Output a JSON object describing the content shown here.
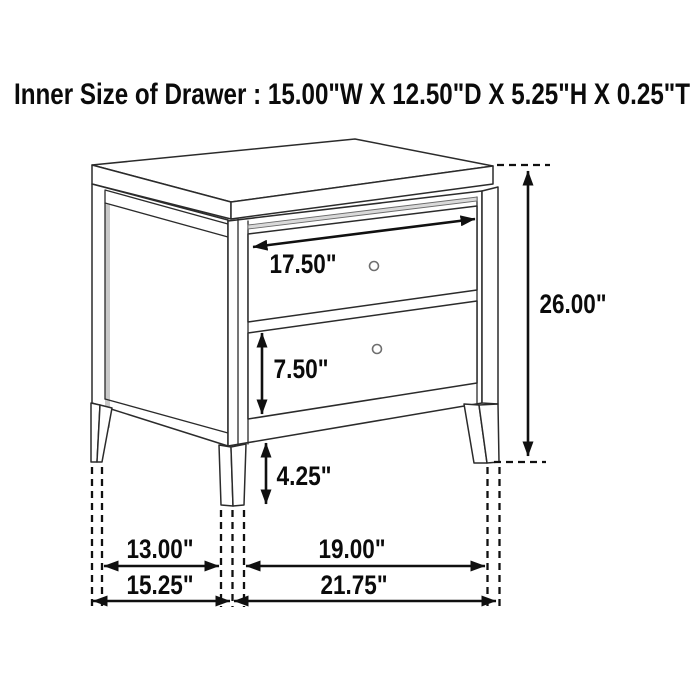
{
  "title": "Inner Size of Drawer : 15.00\"W X 12.50\"D X 5.25\"H X 0.25\"T",
  "labels": {
    "drawer_width": "17.50\"",
    "drawer_front_height": "7.50\"",
    "leg_height": "4.25\"",
    "overall_height": "26.00\"",
    "leg_span_depth_inner": "13.00\"",
    "leg_span_width_inner": "19.00\"",
    "overall_depth": "15.25\"",
    "overall_width": "21.75\""
  },
  "colors": {
    "background": "#ffffff",
    "line": "#2b2b2b",
    "dimension": "#101010",
    "panel_shadow": "#c9c9c9",
    "reveal_strip": "#d9d9d9"
  }
}
